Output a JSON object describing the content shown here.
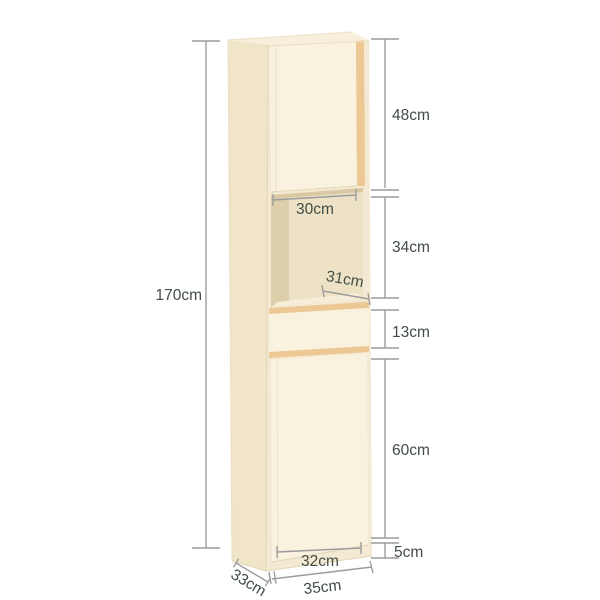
{
  "diagram": {
    "type": "furniture-dimension-diagram",
    "product": "tall bathroom cabinet",
    "labels": {
      "total_height": "170cm",
      "top_door_height": "48cm",
      "niche_width": "30cm",
      "niche_height": "34cm",
      "niche_depth": "31cm",
      "drawer_height": "13cm",
      "bottom_door_height": "60cm",
      "base_height": "5cm",
      "door_width": "32cm",
      "cabinet_depth": "33cm",
      "cabinet_width": "35cm"
    },
    "colors": {
      "background": "#ffffff",
      "front_cream": "#f9f2df",
      "frame_cream": "#f4ead3",
      "side_panel": "#f0e5c9",
      "top_face": "#f7efdb",
      "wood_trim": "#edc794",
      "niche_back": "#eee2c6",
      "niche_left_wall": "#ddcfa9",
      "niche_floor": "#f6eed8",
      "dimension_line": "#9c9c9c",
      "dimension_text": "#414d45"
    }
  }
}
